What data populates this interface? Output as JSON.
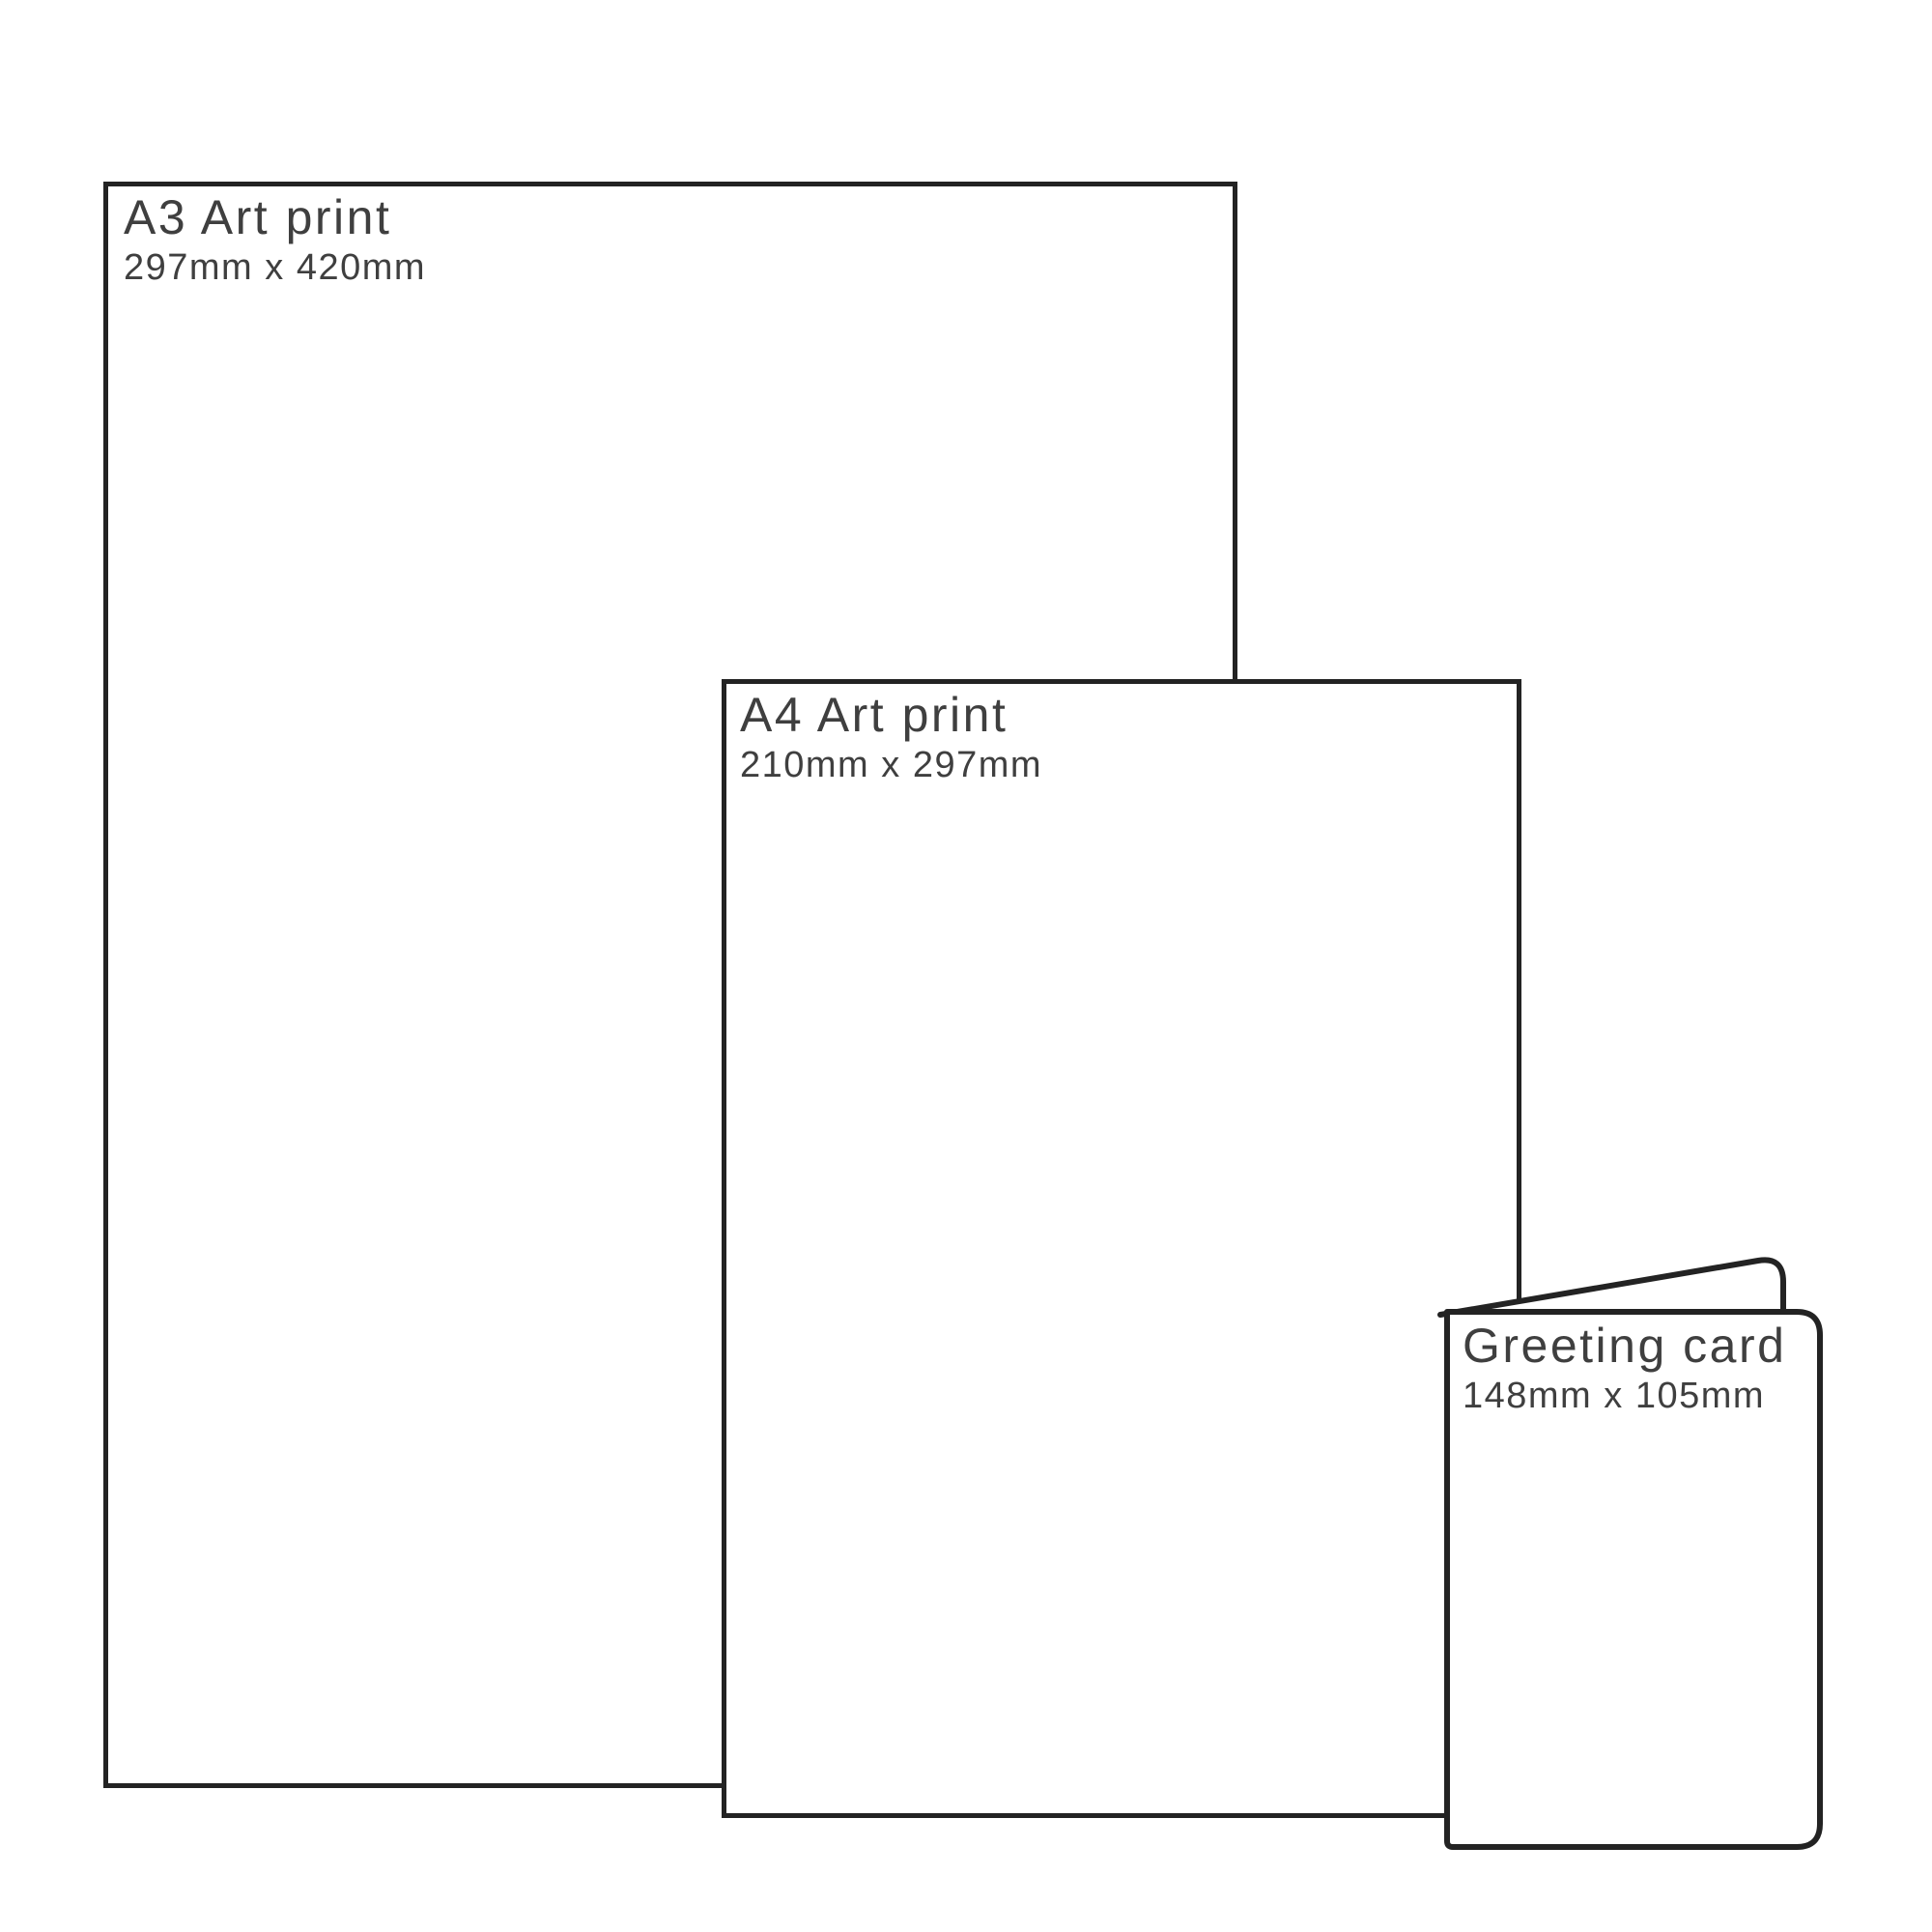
{
  "colors": {
    "outline": "#232323",
    "label_text": "#3f3f3f",
    "background": "#ffffff"
  },
  "items": [
    {
      "title": "A3 Art print",
      "dimensions": "297mm x 420mm"
    },
    {
      "title": "A4 Art print",
      "dimensions": "210mm x 297mm"
    },
    {
      "title": "Greeting card",
      "dimensions": "148mm x 105mm"
    }
  ]
}
